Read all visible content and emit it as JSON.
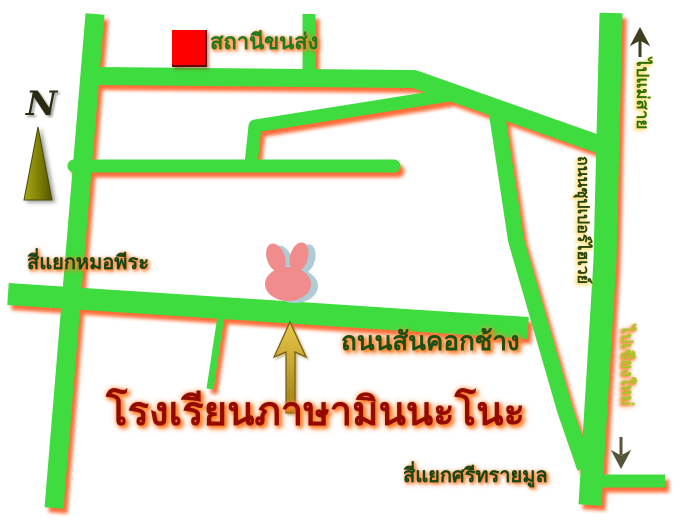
{
  "map": {
    "compass": {
      "label": "N",
      "icon": "north-compass-arrow"
    },
    "markers": {
      "bus_station": {
        "label": "สถานีขนส่ง",
        "icon": "red-square-marker",
        "color": "#FF0000"
      },
      "school": {
        "label": "โรงเรียนภาษามินนะโนะ",
        "icon": "rabbit-marker",
        "pointer_icon": "gold-up-arrow"
      }
    },
    "roads": {
      "san_khok_chang": {
        "label": "ถนนสันคอกช้าง"
      },
      "superhighway": {
        "label": "ถนนซุปเปอร์ไฮเวย์"
      }
    },
    "intersections": {
      "mo_pira": {
        "label": "สี่แยกหมอพีระ"
      },
      "sri_sai_mun": {
        "label": "สี่แยกศรีทรายมูล"
      }
    },
    "directions": {
      "to_mae_sai": {
        "label": "ไปแม่สาย",
        "icon": "up-arrow"
      },
      "to_chiang_mai": {
        "label": "ไปเชียงใหม่",
        "icon": "down-arrow"
      }
    },
    "colors": {
      "road_green": "#3EDC3E",
      "road_shadow_orange": "#FF5316",
      "label_dark_green": "#164514",
      "school_text_red": "#920A00",
      "to_chiang_mai_text_green": "#A8C62B",
      "rabbit_pink": "#F08C8C",
      "rabbit_shadow_blue": "#AECBD6",
      "marker_red": "#FF0000",
      "pointer_gold": "#C9A227"
    }
  }
}
